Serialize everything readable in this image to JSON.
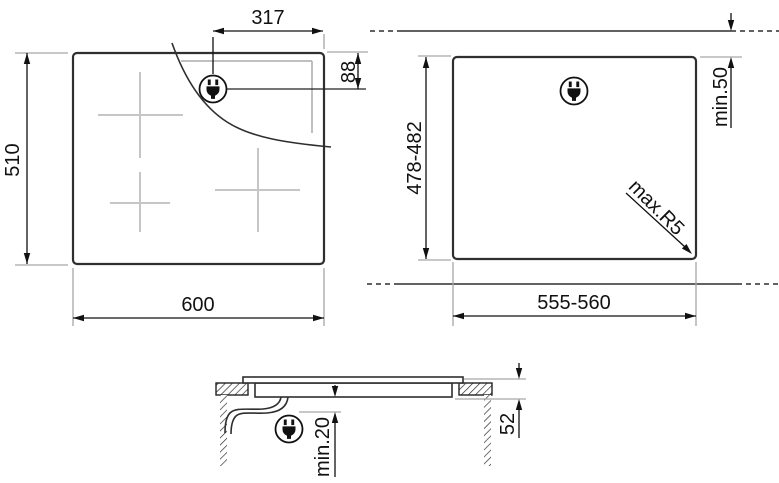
{
  "drawing": {
    "type": "built-in hob installation diagram",
    "views": {
      "top": {
        "overall_width_mm": "600",
        "overall_depth_mm": "510",
        "plug_offset_x_mm": "317",
        "plug_offset_y_mm": "88"
      },
      "cutout": {
        "cutout_width_mm": "555-560",
        "cutout_depth_mm": "478-482",
        "min_rear_clearance": "min.50",
        "max_corner_radius": "max.R5"
      },
      "section": {
        "min_clearance_below": "min.20",
        "built_in_height_mm": "52"
      }
    },
    "icons": {
      "power_plug": "power-plug-icon"
    },
    "colors": {
      "background": "#ffffff",
      "main_line": "#2f2f2f",
      "dimension_line": "#111111",
      "extension_line": "#a6a6a6",
      "zone_cross": "#c6c6c6",
      "glass_inset_line": "#ababab"
    }
  }
}
